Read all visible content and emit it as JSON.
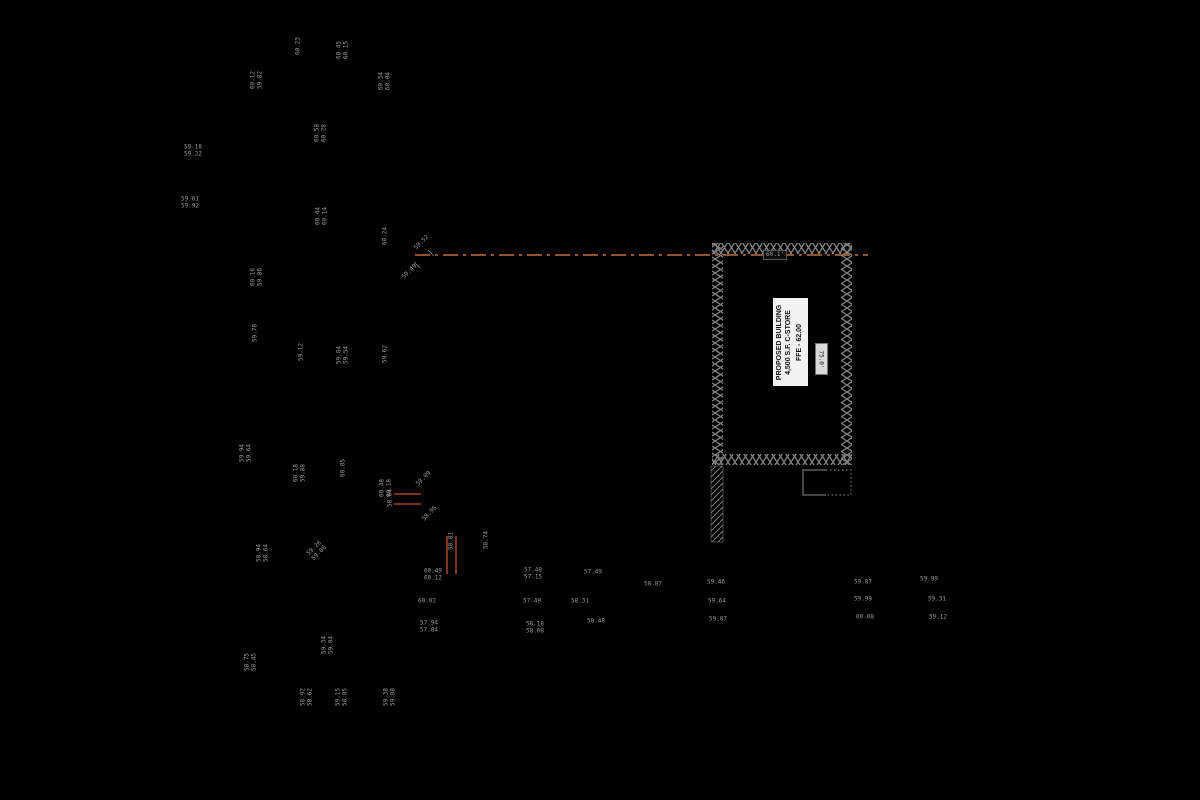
{
  "colors": {
    "background": "#000000",
    "linework": "#8a8a8a",
    "hatch": "#828282",
    "centerline": "#bf6d35",
    "revision_mark": "#c3502f",
    "label_text": "#989898"
  },
  "building": {
    "label_line1": "PROPOSED BUILDING",
    "label_line2": "4,500 S.F. C-STORE",
    "ffe_label": "FFE - 62.00",
    "width_label": "60.1'",
    "depth_label": "75.0'"
  },
  "spot_elevations": [
    {
      "x": 299,
      "y": 46,
      "rot": "v",
      "lines": [
        "60.23"
      ]
    },
    {
      "x": 343,
      "y": 50,
      "rot": "v",
      "lines": [
        "60.45",
        "60.15"
      ]
    },
    {
      "x": 257,
      "y": 80,
      "rot": "v",
      "lines": [
        "60.12",
        "59.82"
      ]
    },
    {
      "x": 385,
      "y": 81,
      "rot": "v",
      "lines": [
        "60.34",
        "60.04"
      ]
    },
    {
      "x": 321,
      "y": 133,
      "rot": "v",
      "lines": [
        "60.58",
        "60.28"
      ]
    },
    {
      "x": 193,
      "y": 151,
      "rot": "h",
      "lines": [
        "59.18",
        "59.22"
      ]
    },
    {
      "x": 190,
      "y": 203,
      "rot": "h",
      "lines": [
        "59.61",
        "59.92"
      ]
    },
    {
      "x": 322,
      "y": 216,
      "rot": "v",
      "lines": [
        "60.44",
        "60.14"
      ]
    },
    {
      "x": 386,
      "y": 236,
      "rot": "v",
      "lines": [
        "60.24"
      ]
    },
    {
      "x": 257,
      "y": 277,
      "rot": "v",
      "lines": [
        "60.16",
        "59.86"
      ]
    },
    {
      "x": 256,
      "y": 333,
      "rot": "v",
      "lines": [
        "59.78"
      ]
    },
    {
      "x": 302,
      "y": 352,
      "rot": "v",
      "lines": [
        "59.12"
      ]
    },
    {
      "x": 343,
      "y": 355,
      "rot": "v",
      "lines": [
        "59.84",
        "59.54"
      ]
    },
    {
      "x": 386,
      "y": 354,
      "rot": "v",
      "lines": [
        "59.62"
      ]
    },
    {
      "x": 246,
      "y": 453,
      "rot": "v",
      "lines": [
        "59.94",
        "59.64"
      ]
    },
    {
      "x": 300,
      "y": 473,
      "rot": "v",
      "lines": [
        "60.18",
        "59.88"
      ]
    },
    {
      "x": 344,
      "y": 468,
      "rot": "v",
      "lines": [
        "60.05"
      ]
    },
    {
      "x": 386,
      "y": 488,
      "rot": "v",
      "lines": [
        "60.48",
        "60.18"
      ]
    },
    {
      "x": 263,
      "y": 553,
      "rot": "v",
      "lines": [
        "58.94",
        "58.64"
      ]
    },
    {
      "x": 317,
      "y": 551,
      "rot": "d",
      "lines": [
        "59.26",
        "59.06"
      ]
    },
    {
      "x": 328,
      "y": 645,
      "rot": "v",
      "lines": [
        "59.34",
        "59.04"
      ]
    },
    {
      "x": 251,
      "y": 662,
      "rot": "v",
      "lines": [
        "58.75",
        "58.45"
      ]
    },
    {
      "x": 307,
      "y": 697,
      "rot": "v",
      "lines": [
        "58.92",
        "58.62"
      ]
    },
    {
      "x": 342,
      "y": 697,
      "rot": "v",
      "lines": [
        "59.15",
        "58.85"
      ]
    },
    {
      "x": 390,
      "y": 697,
      "rot": "v",
      "lines": [
        "59.38",
        "59.08"
      ]
    },
    {
      "x": 422,
      "y": 243,
      "rot": "d",
      "lines": [
        "59.52"
      ]
    },
    {
      "x": 410,
      "y": 272,
      "rot": "d",
      "lines": [
        "59.49"
      ]
    },
    {
      "x": 424,
      "y": 479,
      "rot": "d",
      "lines": [
        "59.09"
      ]
    },
    {
      "x": 430,
      "y": 514,
      "rot": "d",
      "lines": [
        "58.96"
      ]
    },
    {
      "x": 391,
      "y": 498,
      "rot": "v",
      "lines": [
        "58.64"
      ]
    },
    {
      "x": 452,
      "y": 541,
      "rot": "v",
      "lines": [
        "58.81"
      ]
    },
    {
      "x": 487,
      "y": 540,
      "rot": "v",
      "lines": [
        "58.74"
      ]
    },
    {
      "x": 433,
      "y": 575,
      "rot": "h",
      "lines": [
        "60.49",
        "60.12"
      ]
    },
    {
      "x": 427,
      "y": 602,
      "rot": "h",
      "lines": [
        "60.02"
      ]
    },
    {
      "x": 429,
      "y": 627,
      "rot": "h",
      "lines": [
        "57.94",
        "57.84"
      ]
    },
    {
      "x": 533,
      "y": 574,
      "rot": "h",
      "lines": [
        "57.48",
        "57.15"
      ]
    },
    {
      "x": 532,
      "y": 602,
      "rot": "h",
      "lines": [
        "57.49"
      ]
    },
    {
      "x": 593,
      "y": 573,
      "rot": "h",
      "lines": [
        "57.49"
      ]
    },
    {
      "x": 580,
      "y": 602,
      "rot": "h",
      "lines": [
        "58.31"
      ]
    },
    {
      "x": 596,
      "y": 622,
      "rot": "h",
      "lines": [
        "58.48"
      ]
    },
    {
      "x": 535,
      "y": 628,
      "rot": "h",
      "lines": [
        "58.18",
        "58.08"
      ]
    },
    {
      "x": 653,
      "y": 585,
      "rot": "h",
      "lines": [
        "58.87"
      ]
    },
    {
      "x": 716,
      "y": 583,
      "rot": "h",
      "lines": [
        "59.46"
      ]
    },
    {
      "x": 717,
      "y": 602,
      "rot": "h",
      "lines": [
        "59.64"
      ]
    },
    {
      "x": 718,
      "y": 620,
      "rot": "h",
      "lines": [
        "59.87"
      ]
    },
    {
      "x": 863,
      "y": 583,
      "rot": "h",
      "lines": [
        "59.87"
      ]
    },
    {
      "x": 863,
      "y": 600,
      "rot": "h",
      "lines": [
        "59.99"
      ]
    },
    {
      "x": 865,
      "y": 618,
      "rot": "h",
      "lines": [
        "60.08"
      ]
    },
    {
      "x": 929,
      "y": 580,
      "rot": "h",
      "lines": [
        "59.99"
      ]
    },
    {
      "x": 937,
      "y": 600,
      "rot": "h",
      "lines": [
        "59.31"
      ]
    },
    {
      "x": 938,
      "y": 618,
      "rot": "h",
      "lines": [
        "59.12"
      ]
    }
  ]
}
